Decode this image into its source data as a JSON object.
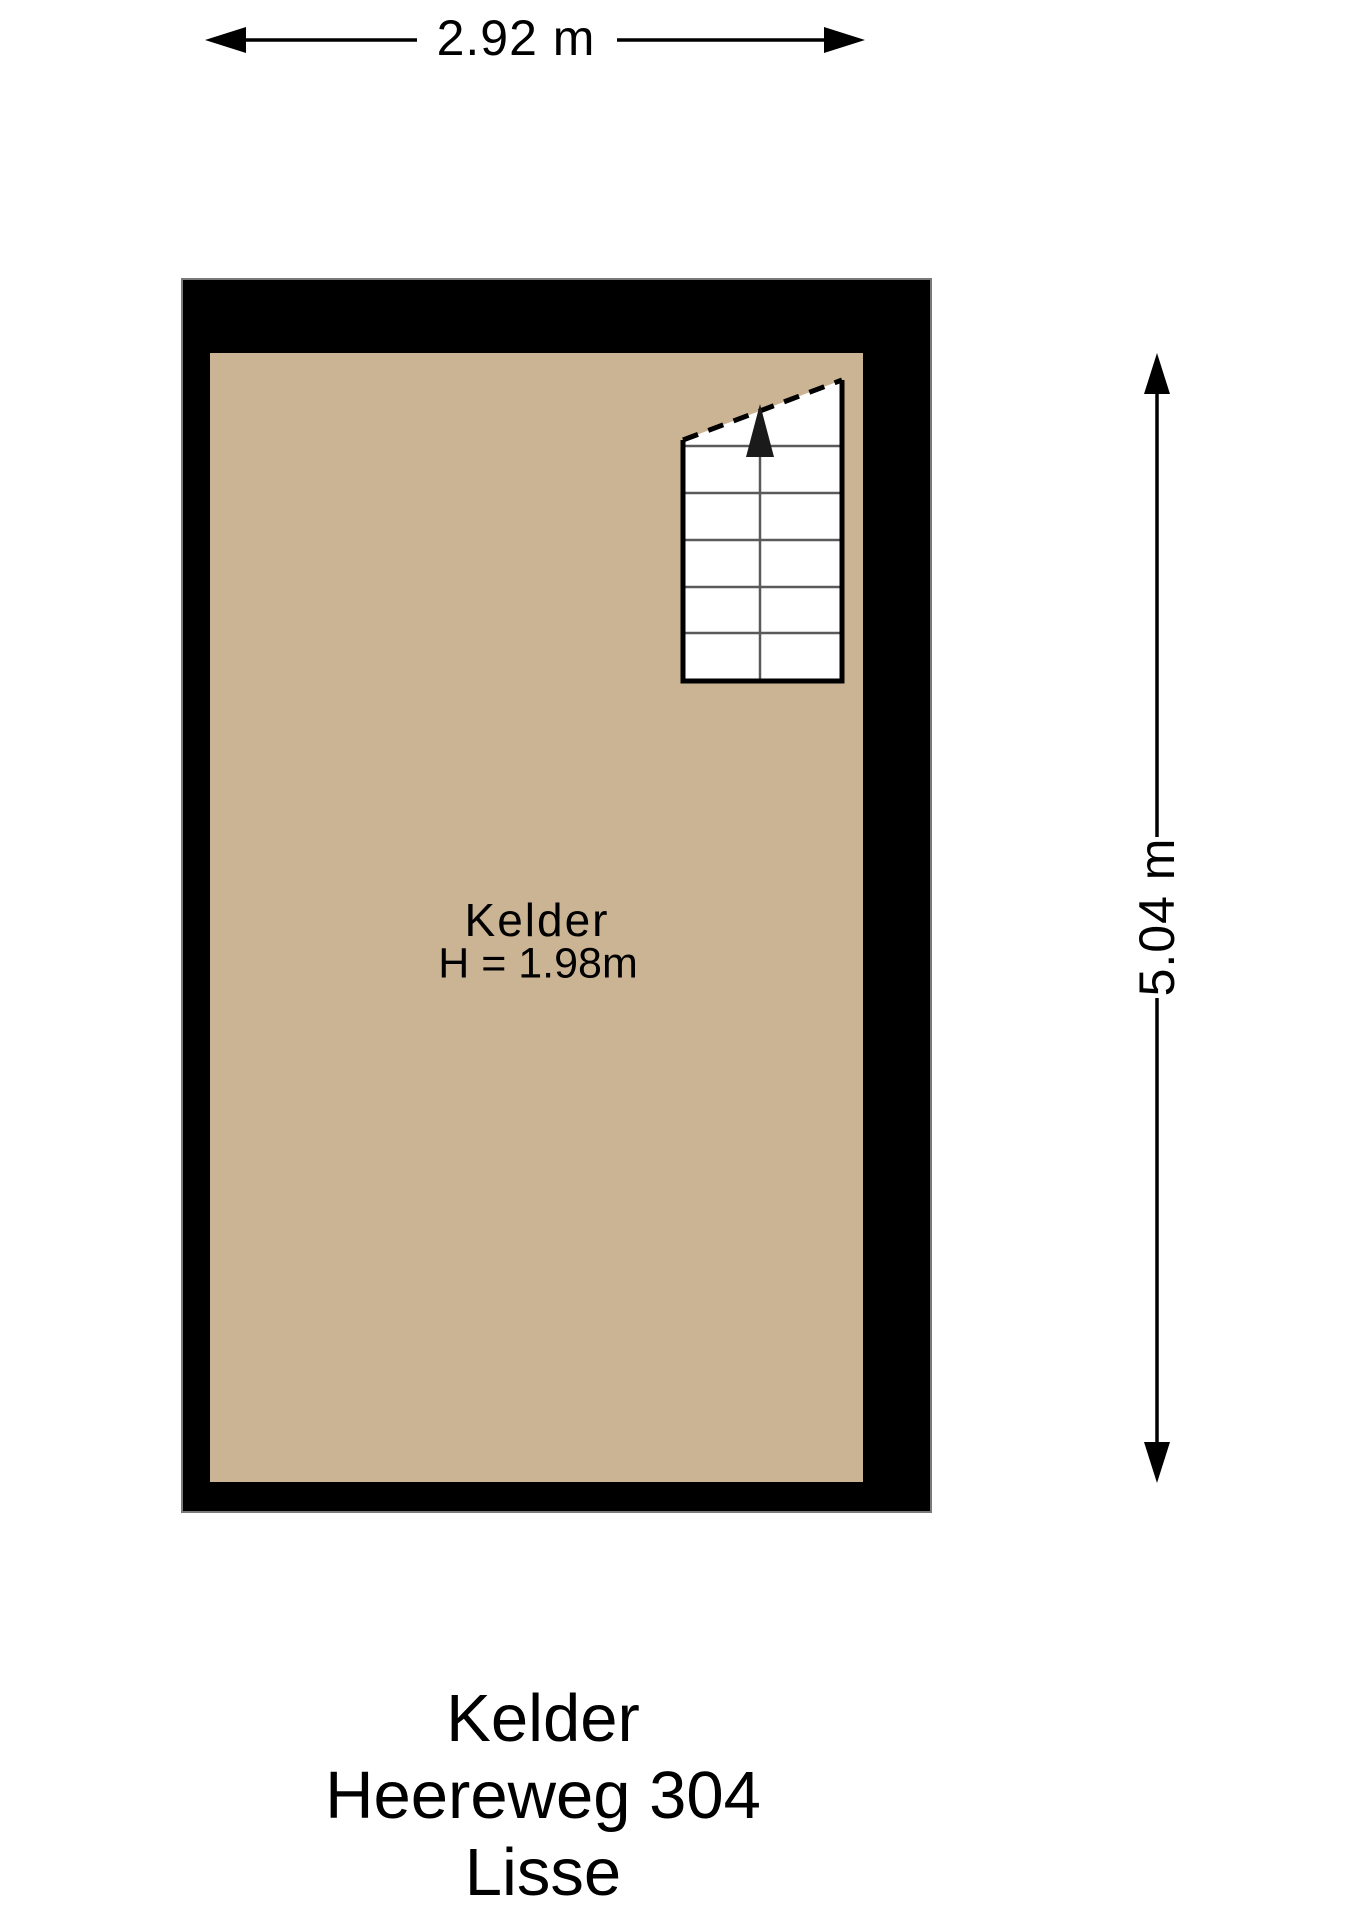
{
  "colors": {
    "wall": "#000000",
    "floor": "#cbb494",
    "stair_fill": "#ffffff",
    "stair_line": "#5a5a5a",
    "stair_border": "#000000",
    "wall_outline": "#7a7a7a",
    "arrow": "#1a1a1a",
    "dimension_line": "#000000"
  },
  "room": {
    "name": "Kelder",
    "ceiling_height": "H = 1.98m"
  },
  "dimensions": {
    "width": "2.92 m",
    "height": "5.04 m"
  },
  "title_block": {
    "room": "Kelder",
    "address": "Heereweg 304",
    "city": "Lisse"
  }
}
